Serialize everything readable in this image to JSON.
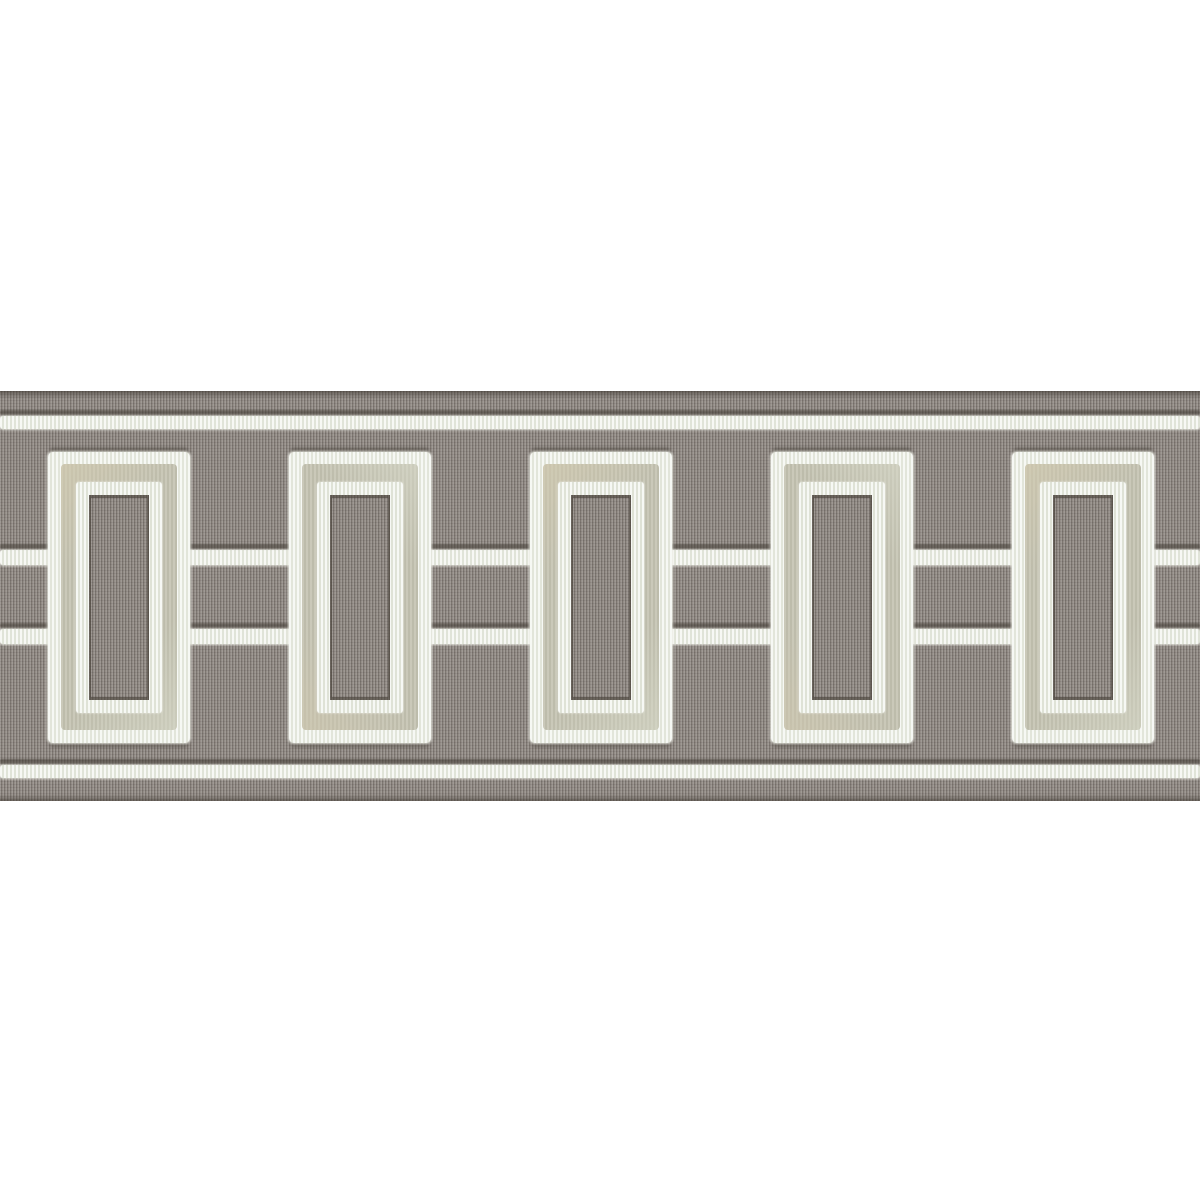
{
  "scene": {
    "type": "product-photo",
    "subject": "Decorative fabric tape trim (border) on a white background",
    "description": "Horizontal gray grosgrain ribbon with an embroidered geometric chain pattern: five vertical open rectangles of pale sage velvet appliqued with white satin-stitch outlines, linked by two horizontal embroidered white lines, and bordered by a single embroidered white line near the top and bottom edges of the tape."
  },
  "colors": {
    "background": "#ffffff",
    "ribbon_gray": "#8b847e",
    "ribbon_rib_light": "#9d978f",
    "ribbon_rib_dark": "#746e67",
    "ribbon_edge_dark": "#6b655e",
    "embroidery_white": "#eef0e8",
    "velvet_sage": "#c5c4b3",
    "velvet_beige_patch": "#cdc5ae",
    "stitch_shadow": "#57514a"
  },
  "band": {
    "left": 0,
    "top": 391,
    "width": 1200,
    "height": 410
  },
  "hlines": [
    {
      "name": "embroidered-line-top-edge",
      "y": 416,
      "height": 13
    },
    {
      "name": "embroidered-line-middle-upper",
      "y": 550,
      "height": 15
    },
    {
      "name": "embroidered-line-middle-lower",
      "y": 629,
      "height": 15
    },
    {
      "name": "embroidered-line-bottom-edge",
      "y": 765,
      "height": 13
    }
  ],
  "rectangles": {
    "count": 5,
    "top": 452,
    "width": 142,
    "height": 291,
    "lefts": [
      48,
      289,
      530,
      771,
      1012
    ],
    "layers": [
      "outer-white-satin-stitch-outline",
      "sage-velvet-frame",
      "inner-white-satin-stitch-outline",
      "gray-grosgrain-center"
    ]
  }
}
